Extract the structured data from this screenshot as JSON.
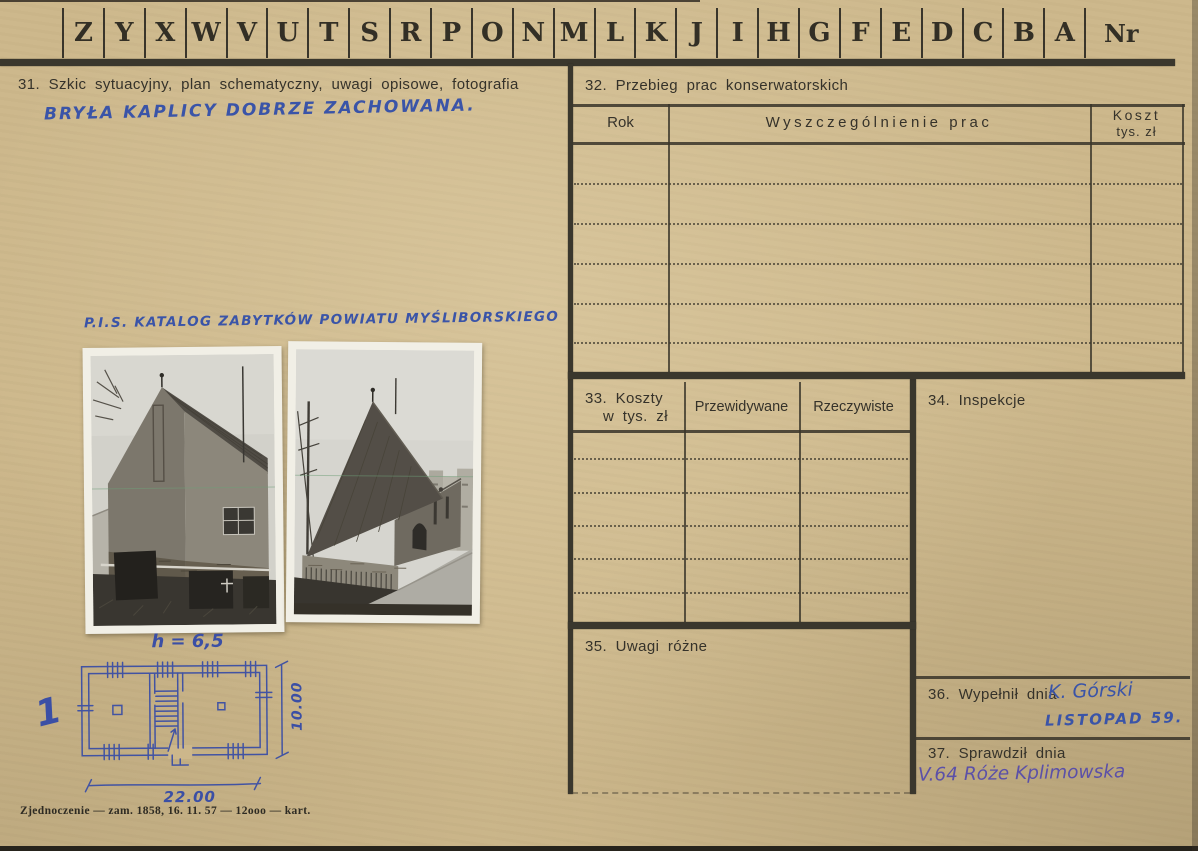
{
  "card": {
    "index_strip": {
      "letters": [
        "Z",
        "Y",
        "X",
        "W",
        "V",
        "U",
        "T",
        "S",
        "R",
        "P",
        "O",
        "N",
        "M",
        "L",
        "K",
        "J",
        "I",
        "H",
        "G",
        "F",
        "E",
        "D",
        "C",
        "B",
        "A"
      ],
      "nr_label": "Nr"
    },
    "section31": {
      "title": "31. Szkic sytuacyjny, plan schematyczny, uwagi opisowe, fotografia",
      "note_handwritten": "BRYŁA KAPLICY DOBRZE ZACHOWANA.",
      "catalog_handwritten": "P.I.S. KATALOG ZABYTKÓW POWIATU MYŚLIBORSKIEGO"
    },
    "section32": {
      "title": "32. Przebieg prac konserwatorskich",
      "col_rok": "Rok",
      "col_prace": "Wyszczególnienie prac",
      "col_koszt_line1": "Koszt",
      "col_koszt_line2": "tys. zł",
      "rows": []
    },
    "section33": {
      "title_line1": "33. Koszty",
      "title_line2": "w tys. zł",
      "col_przewidywane": "Przewidywane",
      "col_rzeczywiste": "Rzeczywiste",
      "rows": []
    },
    "section34": {
      "title": "34. Inspekcje"
    },
    "section35": {
      "title": "35. Uwagi różne"
    },
    "section36": {
      "title": "36. Wypełnił dnia",
      "name_handwritten": "K. Górski",
      "date_handwritten": "LISTOPAD 59."
    },
    "section37": {
      "title": "37. Sprawdził dnia",
      "entry_handwritten": "V.64 Róże Kplimowska"
    },
    "sketch": {
      "height_label": "h = 6,5",
      "width_label": "22.00",
      "depth_label": "10.00",
      "page_mark": "1"
    },
    "footer": {
      "print_note": "Zjednoczenie — zam. 1858, 16. 11. 57 — 12ooo — kart."
    },
    "colors": {
      "paper": "#cdb88c",
      "ink_blue": "#3a54a8",
      "ink_violet": "#5b50a8",
      "print_ink": "#35322a"
    }
  }
}
